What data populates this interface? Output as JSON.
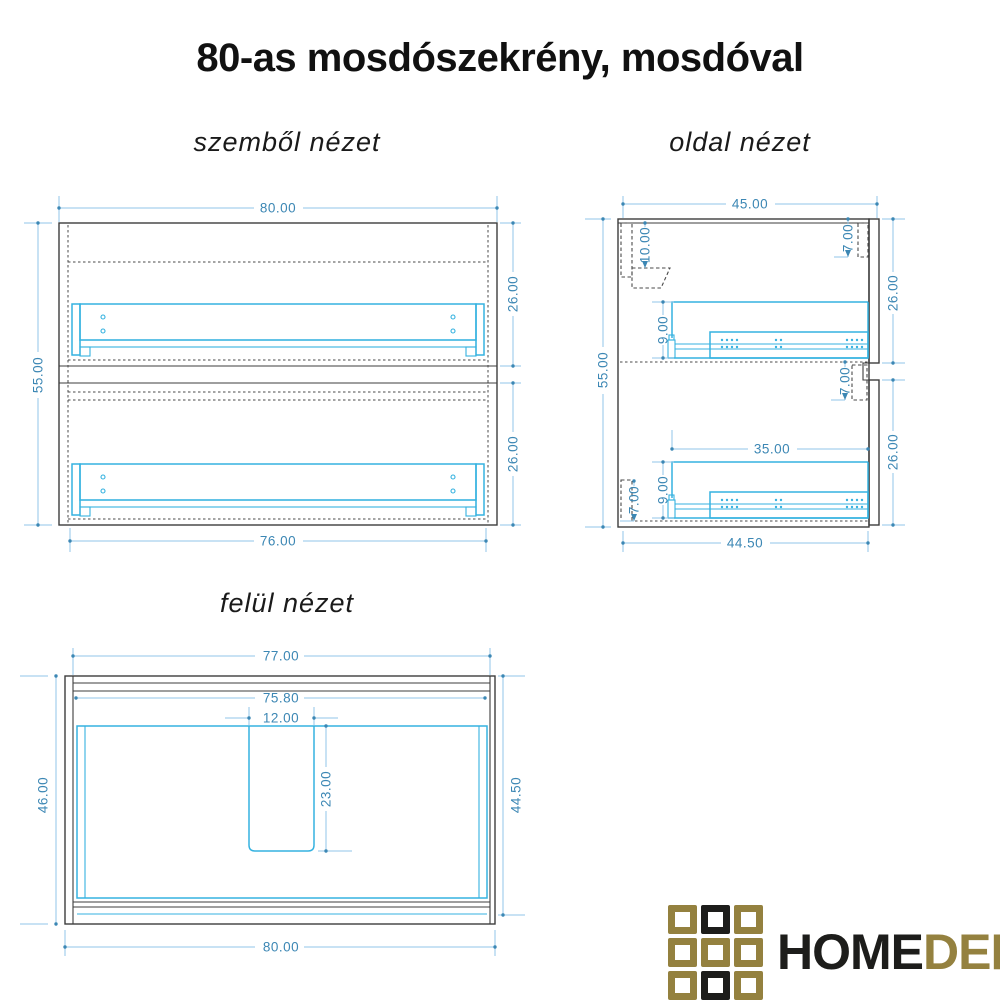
{
  "title": "80-as mosdószekrény, mosdóval",
  "views": {
    "front": {
      "label": "szemből nézet",
      "dims": {
        "top_width": "80.00",
        "drawer_upper_height": "26.00",
        "drawer_lower_height": "26.00",
        "total_height": "55.00",
        "bottom_width": "76.00"
      }
    },
    "side": {
      "label": "oldal nézet",
      "dims": {
        "top_depth": "45.00",
        "hanger_offset": "10.00",
        "front_gap_top": "7.00",
        "front_upper_height": "26.00",
        "rail_upper_height": "9.00",
        "total_height": "55.00",
        "front_gap_mid": "7.00",
        "drawer_depth": "35.00",
        "rail_lower_height": "9.00",
        "plinth_gap": "7.00",
        "front_lower_height": "26.00",
        "bottom_depth": "44.50"
      }
    },
    "top": {
      "label": "felül nézet",
      "dims": {
        "carcass_width": "77.00",
        "inner_width": "75.80",
        "cutout_width": "12.00",
        "cutout_depth": "23.00",
        "left_depth": "46.00",
        "right_depth": "44.50",
        "total_width": "80.00"
      }
    }
  },
  "logo": {
    "text_primary": "HOME",
    "text_secondary": "DEPO",
    "grid": [
      "gold",
      "black",
      "gold",
      "gold",
      "gold",
      "gold",
      "gold",
      "black",
      "gold"
    ],
    "colors": {
      "gold": "#94813f",
      "black": "#1d1d1b"
    }
  },
  "colors": {
    "outline": "#3d3d3d",
    "hidden_line": "#4a4a4a",
    "drawer": "#35b2e0",
    "dim_line": "#90c6e8",
    "dim_text": "#3c87b4"
  }
}
